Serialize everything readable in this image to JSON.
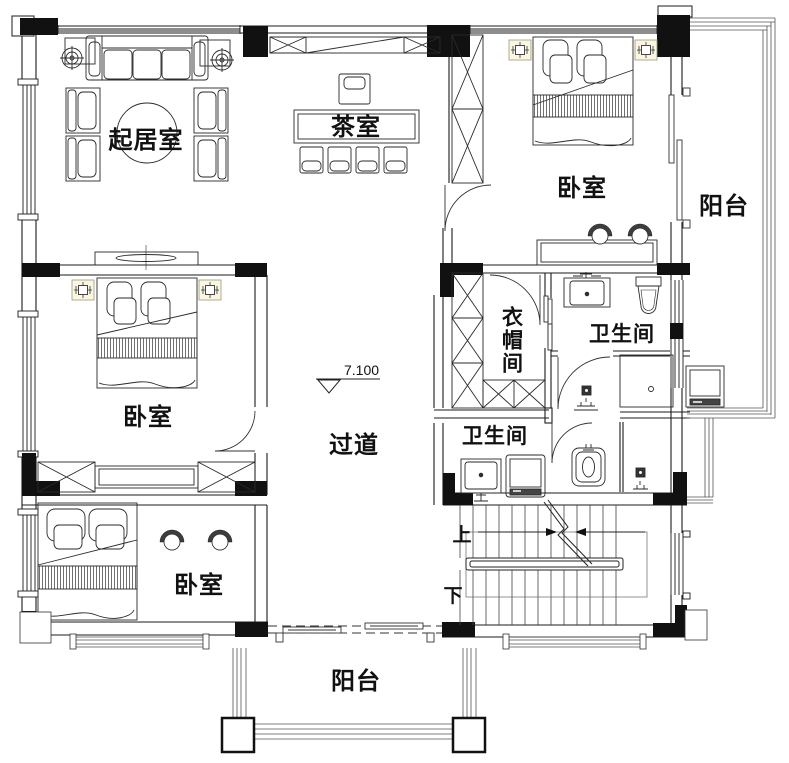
{
  "plan": {
    "rooms": {
      "living_room": "起居室",
      "tea_room": "茶室",
      "bedroom_top_right": "卧室",
      "bedroom_middle_left": "卧室",
      "bedroom_bottom_left": "卧室",
      "cloakroom": "衣帽间",
      "bathroom_upper": "卫生间",
      "bathroom_lower": "卫生间",
      "hallway": "过道",
      "balcony_right": "阳台",
      "balcony_bottom": "阳台"
    },
    "stairs": {
      "up_label": "上",
      "down_label": "下"
    },
    "elevation_marker": "7.100",
    "colors": {
      "line": "#1b1b1b",
      "nightstand_tint": "#faf6e2",
      "paper": "#ffffff"
    }
  }
}
